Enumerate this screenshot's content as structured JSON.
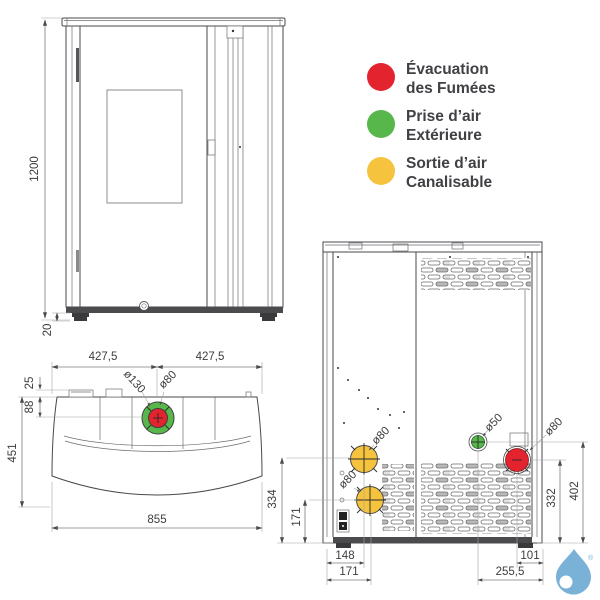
{
  "colors": {
    "red": "#e3232e",
    "green": "#57b74a",
    "yellow": "#f6c33e",
    "line": "#4a4a4d",
    "dim_text": "#3d3d3f",
    "legend_text": "#414045",
    "logo": "#79b1d7"
  },
  "legend": {
    "items": [
      {
        "id": "flue-exhaust",
        "color": "red",
        "line1": "Évacuation",
        "line2": "des Fumées"
      },
      {
        "id": "outside-air-intake",
        "color": "green",
        "line1": "Prise d’air",
        "line2": "Extérieure"
      },
      {
        "id": "ductable-air-outlet",
        "color": "yellow",
        "line1": "Sortie d’air",
        "line2": "Canalisable"
      }
    ]
  },
  "front_view": {
    "dims": {
      "height": "1200",
      "feet_height": "20"
    }
  },
  "top_view": {
    "dims": {
      "left_half_width": "427,5",
      "right_half_width": "427,5",
      "lid_offset": "25",
      "flue_offset_from_back": "88",
      "depth": "451",
      "width": "855",
      "air_ring_diameter": "ø130",
      "flue_diameter": "ø80"
    }
  },
  "rear_view": {
    "dims": {
      "upper_duct_diameter": "ø80",
      "lower_duct_diameter": "ø80",
      "air_intake_diameter": "ø50",
      "flue_diameter": "ø80",
      "upper_duct_center_height": "334",
      "lower_duct_center_height": "171",
      "flue_center_height": "332",
      "air_intake_center_height": "402",
      "upper_duct_center_x": "148",
      "lower_duct_center_x": "171",
      "flue_center_from_right": "101",
      "air_intake_center_from_right": "255,5"
    }
  },
  "logo": {
    "registered": "®"
  }
}
